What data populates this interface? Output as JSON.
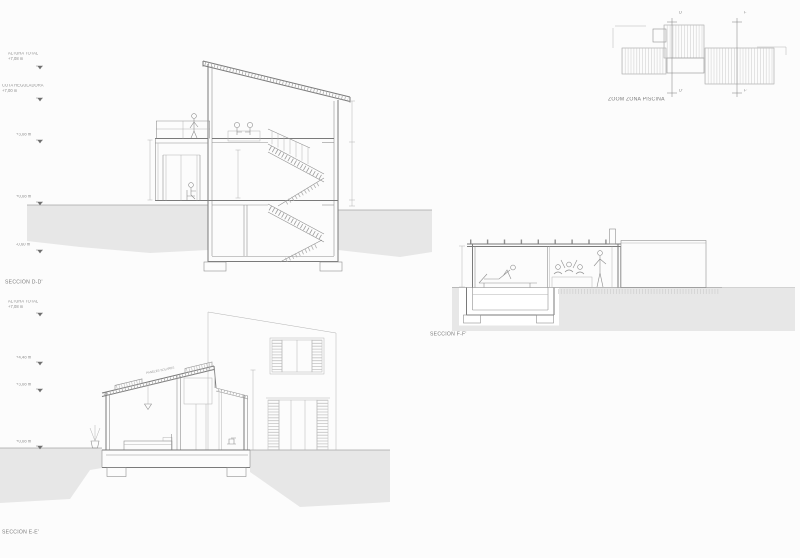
{
  "colors": {
    "line": "#8f8f8f",
    "cut_line": "#7a7a7a",
    "ground_fill": "#e7e7e7",
    "hatch": "#c9c9c9",
    "text": "#8a8a8a"
  },
  "sections": {
    "dd": {
      "title": "SECCIÓN D-D'",
      "levels": [
        {
          "label": "ALTURA TOTAL",
          "value": "+7,08 m"
        },
        {
          "label": "COTA REGULADORA",
          "value": "+7,00 m"
        },
        {
          "value": "+3,08 m"
        },
        {
          "value": "+0,08 m"
        },
        {
          "value": "-0,60 m"
        }
      ]
    },
    "ee": {
      "title": "SECCIÓN E-E'",
      "roof_note": "PANELES SOLARES",
      "levels": [
        {
          "label": "ALTURA TOTAL",
          "value": "+7,08 m"
        },
        {
          "value": "+4,48 m"
        },
        {
          "value": "+3,08 m"
        },
        {
          "value": "+0,08 m"
        }
      ]
    },
    "ff": {
      "title": "SECCIÓN F-F'"
    },
    "plan": {
      "title": "ZOOM ZONA PISCINA",
      "markers": {
        "d_top": "D",
        "d_bottom": "D'",
        "f_top": "F",
        "f_bottom": "F'"
      }
    }
  }
}
